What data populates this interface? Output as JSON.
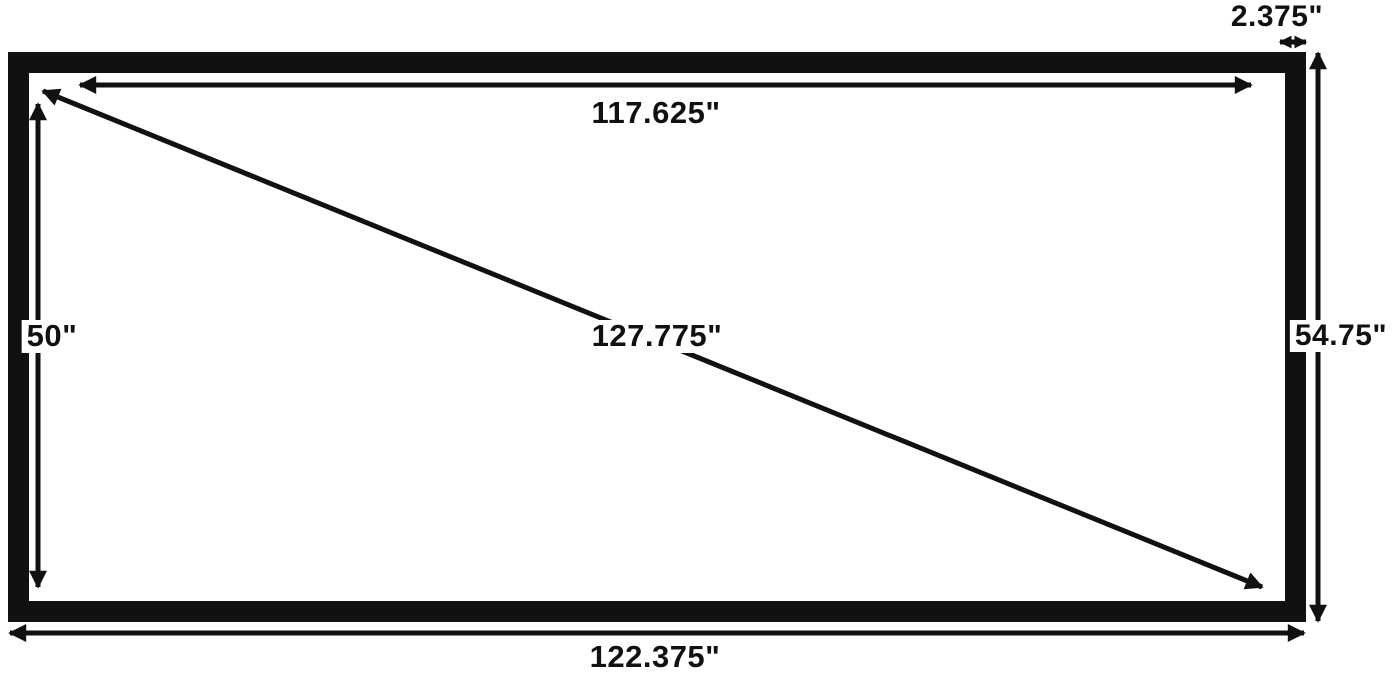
{
  "diagram": {
    "subject": "screen-dimension-diagram",
    "colors": {
      "ink": "#111111",
      "background": "#ffffff"
    },
    "dimensions": {
      "inner_width": "117.625\"",
      "outer_width": "122.375\"",
      "inner_height": "50\"",
      "outer_height": "54.75\"",
      "diagonal": "127.775\"",
      "border_width": "2.375\""
    }
  }
}
